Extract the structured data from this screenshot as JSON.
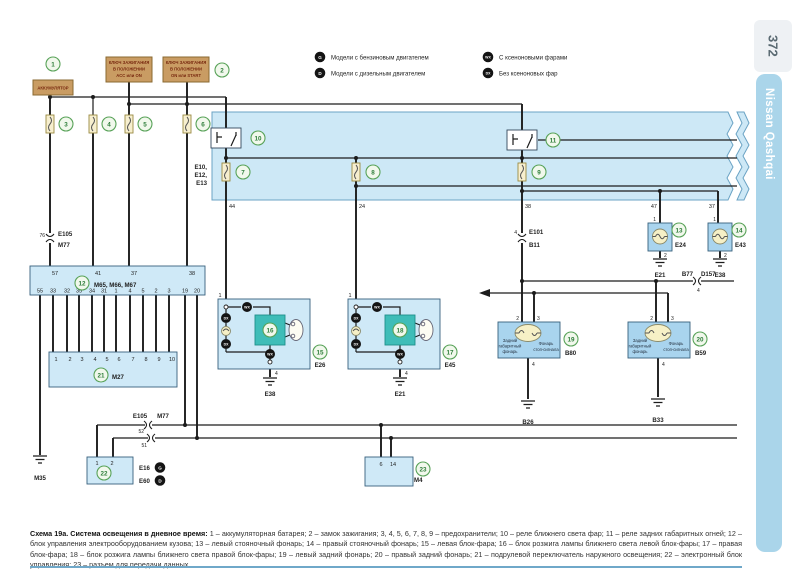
{
  "page": {
    "number": "372",
    "brand": "Nissan Qashqai"
  },
  "colors": {
    "diagram_box_blue": "#cde8f6",
    "component_blue": "#cfe9f7",
    "teal_igniter": "#3fbdb8",
    "tan_power_box": "#c99c63",
    "brand_bar": "#aad5ea",
    "green_circle": "#58a258",
    "caption_rule": "#6fa8c9"
  },
  "legend": {
    "g": {
      "badge": "G",
      "label": "Модели с бензиновым двигателем"
    },
    "d": {
      "badge": "D",
      "label": "Модели с дизельным двигателем"
    },
    "wx": {
      "badge": "WX",
      "label": "С ксеноновыми фарами"
    },
    "dx": {
      "badge": "DX",
      "label": "Без ксеноновых фар"
    }
  },
  "badge": {
    "g": "G",
    "d": "D",
    "wx": "WX",
    "dx": "DX"
  },
  "num": {
    "1": "1",
    "2": "2",
    "3": "3",
    "4": "4",
    "5": "5",
    "6": "6",
    "7": "7",
    "8": "8",
    "9": "9",
    "10": "10",
    "11": "11",
    "12": "12",
    "13": "13",
    "14": "14",
    "15": "15",
    "16": "16",
    "17": "17",
    "18": "18",
    "19": "19",
    "20": "20",
    "21": "21",
    "22": "22",
    "23": "23"
  },
  "top": {
    "battery": "АККУМУЛЯТОР",
    "ign1": [
      "КЛЮЧ ЗАЖИГАНИЯ",
      "В ПОЛОЖЕНИИ",
      "ACC или ON"
    ],
    "ign2": [
      "КЛЮЧ ЗАЖИГАНИЯ",
      "В ПОЛОЖЕНИИ",
      "ON или START"
    ]
  },
  "relaybox": {
    "conn_stack": [
      "E10,",
      "E12,",
      "E13"
    ],
    "p44": "44",
    "p24": "24",
    "p38": "38",
    "p47": "47",
    "p37": "37"
  },
  "conn_top": {
    "pin": "76",
    "a": "E105",
    "b": "M77"
  },
  "conn_e101": {
    "pin": "4",
    "a": "E101",
    "b": "B11"
  },
  "conn_b77": {
    "a": "B77",
    "b": "D157",
    "pin": "4"
  },
  "conn_bot": {
    "a": "E105",
    "b": "M77",
    "p1": "52",
    "p2": "51"
  },
  "m65": {
    "title": "M65, M66, M67",
    "top": [
      "57",
      "41",
      "37",
      "38"
    ],
    "bottom": [
      "55",
      "33",
      "32",
      "35",
      "34",
      "31",
      "1",
      "4",
      "5",
      "2",
      "3",
      "19",
      "20"
    ]
  },
  "m27": {
    "code": "M27",
    "top": [
      "1",
      "2",
      "3",
      "4",
      "5",
      "6",
      "7",
      "8",
      "9",
      "10"
    ]
  },
  "park_l": {
    "top": "1",
    "code": "E24",
    "bot": "2",
    "gnd": "E21"
  },
  "park_r": {
    "top": "1",
    "code": "E43",
    "bot": "2",
    "gnd": "E38"
  },
  "hl_l": {
    "top": "1",
    "code": "E26",
    "bot": "4",
    "gnd": "E38"
  },
  "hl_r": {
    "top": "1",
    "code": "E45",
    "bot": "4",
    "gnd": "E21"
  },
  "rear_lamp1": [
    "Задний",
    "габаритный",
    "фонарь"
  ],
  "rear_lamp2": [
    "Фонарь",
    "стоп-сигнала"
  ],
  "rear_l": {
    "p2": "2",
    "p3": "3",
    "p4": "4",
    "code": "B80",
    "gnd": "B26"
  },
  "rear_r": {
    "p2": "2",
    "p3": "3",
    "p4": "4",
    "code": "B59",
    "gnd": "B33"
  },
  "ecu": {
    "p1": "1",
    "p2": "2",
    "c1": "E16",
    "c2": "E60"
  },
  "m4": {
    "p6": "6",
    "p14": "14",
    "code": "M4"
  },
  "m35": "M35",
  "caption": {
    "title": "Схема 19а. Система освещения в дневное время:",
    "body": "1 – аккумуляторная батарея; 2 – замок зажигания; 3, 4, 5, 6, 7, 8, 9 – предохранители; 10 – реле ближнего света фар; 11 – реле задних габаритных огней; 12 – блок управления электрооборудованием кузова; 13 – левый стояночный фонарь; 14 – правый стояночный фонарь; 15 – левая блок-фара; 16 – блок розжига лампы ближнего света левой блок-фары; 17 – правая блок-фара; 18 – блок розжига лампы ближнего света правой блок-фары; 19 – левый задний фонарь; 20 – правый задний фонарь; 21 – подрулевой переключатель наружного освещения; 22 – электронный блок управления; 23 – разъем для передачи данных"
  }
}
